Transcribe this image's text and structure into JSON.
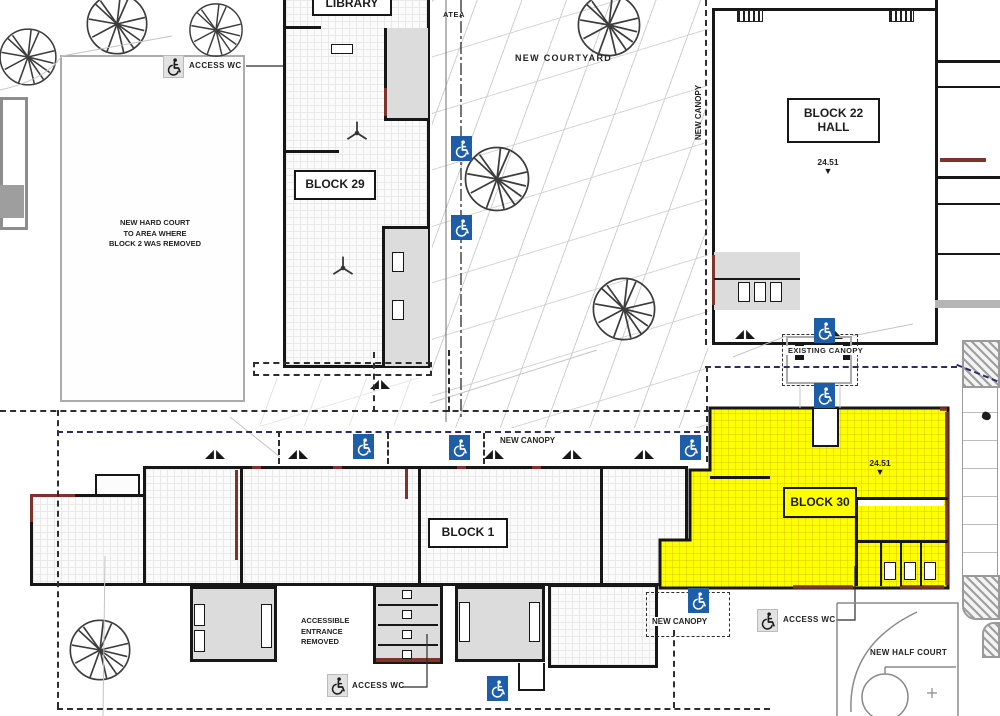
{
  "labels": {
    "library": "LIBRARY",
    "atea": "ATEA",
    "new_courtyard": "NEW COURTYARD",
    "block_29": "BLOCK 29",
    "block_22": "BLOCK 22\nHALL",
    "block_1": "BLOCK 1",
    "block_30": "BLOCK 30",
    "new_canopy_block22": "NEW CANOPY",
    "new_canopy_block1": "NEW CANOPY",
    "new_canopy_block30": "NEW CANOPY",
    "existing_canopy": "EXISTING CANOPY",
    "new_half_court": "NEW HALF COURT"
  },
  "notes": {
    "hard_court": "NEW HARD COURT\nTO AREA WHERE\nBLOCK 2 WAS REMOVED",
    "accessible_entrance": "ACCESSIBLE\nENTRANCE\nREMOVED"
  },
  "access_wc": {
    "top_left": "ACCESS WC",
    "block_1": "ACCESS WC",
    "block_30": "ACCESS WC"
  },
  "levels": {
    "block_22": "24.51",
    "block_30": "24.51",
    "marker": "▼"
  },
  "colors": {
    "highlight_yellow": "#FFFF00",
    "accessible_blue": "#1E5EA9",
    "accent_red": "#7C342B",
    "room_gray": "#DCDCDC",
    "boundary_navy": "#2D2D66"
  },
  "icons": {
    "wheelchair": "wheelchair-icon",
    "tree": "tree-icon",
    "ceiling_fan": "fan-icon",
    "level_marker": "down-triangle-icon"
  }
}
